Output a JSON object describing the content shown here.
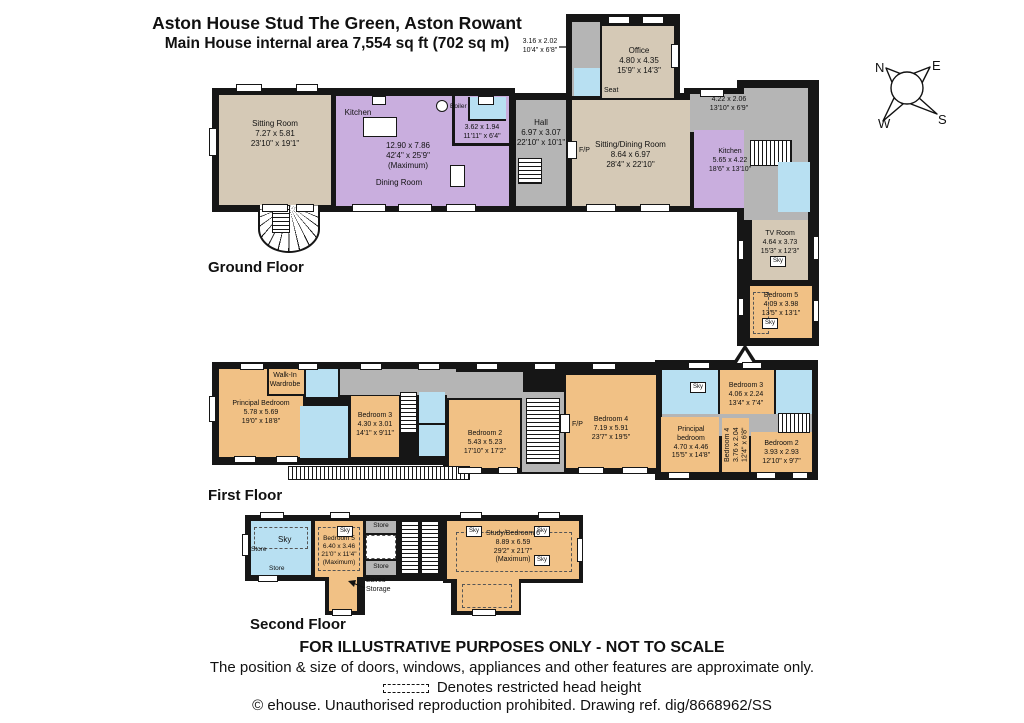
{
  "header": {
    "line1": "Aston House Stud The Green, Aston Rowant",
    "line2": "Main House internal area 7,554 sq ft (702 sq m)"
  },
  "compass": {
    "n": "N",
    "e": "E",
    "s": "S",
    "w": "W"
  },
  "labels": {
    "sky": "Sky",
    "fp": "F/P",
    "seat": "Seat",
    "boiler": "Boiler",
    "store": "Store"
  },
  "floors": {
    "ground": {
      "title": "Ground Floor",
      "annotation": [
        "3.16 x 2.02",
        "10'4\" x 6'8\""
      ],
      "rooms": {
        "sitting_room": [
          "Sitting Room",
          "7.27 x 5.81",
          "23'10\" x 19'1\""
        ],
        "kitchen_name": "Kitchen",
        "kitchen_dining_dims": [
          "12.90 x 7.86",
          "42'4\" x 25'9\"",
          "(Maximum)"
        ],
        "dining_room": "Dining Room",
        "utility": [
          "3.62 x 1.94",
          "11'11\" x 6'4\""
        ],
        "hall": [
          "Hall",
          "6.97 x 3.07",
          "22'10\" x 10'1\""
        ],
        "sitting_dining": [
          "Sitting/Dining Room",
          "8.64 x 6.97",
          "28'4\" x 22'10\""
        ],
        "office": [
          "Office",
          "4.80 x 4.35",
          "15'9\" x 14'3\""
        ],
        "porch": [
          "4.22 x 2.06",
          "13'10\" x 6'9\""
        ],
        "kitchen2": [
          "Kitchen",
          "5.65 x 4.22",
          "18'6\" x 13'10\""
        ],
        "tv_room": [
          "TV Room",
          "4.64 x 3.73",
          "15'3\" x 12'3\""
        ],
        "bedroom5": [
          "Bedroom 5",
          "4.09 x 3.98",
          "13'5\" x 13'1\""
        ]
      }
    },
    "first": {
      "title": "First Floor",
      "rooms": {
        "principal_bedroom": [
          "Principal Bedroom",
          "5.78 x 5.69",
          "19'0\" x 18'8\""
        ],
        "walk_in": [
          "Walk-In",
          "Wardrobe"
        ],
        "bedroom3": [
          "Bedroom 3",
          "4.30 x 3.01",
          "14'1\" x 9'11\""
        ],
        "bedroom2": [
          "Bedroom 2",
          "5.43 x 5.23",
          "17'10\" x 17'2\""
        ],
        "bedroom4": [
          "Bedroom 4",
          "7.19 x 5.91",
          "23'7\" x 19'5\""
        ],
        "bedroom3_right": [
          "Bedroom 3",
          "4.06 x 2.24",
          "13'4\" x 7'4\""
        ],
        "principal_right": [
          "Principal",
          "bedroom",
          "4.70 x 4.46",
          "15'5\" x 14'8\""
        ],
        "bedroom4_right": [
          "Bedroom 4",
          "3.76 x 2.04",
          "12'4\" x 6'8\""
        ],
        "bedroom2_right": [
          "Bedroom 2",
          "3.93 x 2.93",
          "12'10\" x 9'7\""
        ]
      }
    },
    "second": {
      "title": "Second Floor",
      "rooms": {
        "bedroom5": [
          "Bedroom 5",
          "6.40 x 3.46",
          "21'0\" x 11'4\"",
          "(Maximum)"
        ],
        "study_bedroom6": [
          "Study/Bedroom 6",
          "8.89 x 6.59",
          "29'2\" x 21'7\"",
          "(Maximum)"
        ],
        "eaves_storage": [
          "Eaves",
          "Storage"
        ]
      }
    }
  },
  "footer": {
    "line1": "FOR ILLUSTRATIVE PURPOSES ONLY - NOT TO SCALE",
    "line2": "The position & size of doors, windows, appliances and other features are approximate only.",
    "line3": "Denotes restricted head height",
    "line4": "© ehouse. Unauthorised reproduction prohibited. Drawing ref. dig/8668962/SS"
  },
  "colors": {
    "wall": "#161616",
    "reception_beige": "#d5c9b6",
    "kitchen_purple": "#c9aede",
    "circulation_gray": "#b5b5b5",
    "bathroom_blue": "#b8e0f2",
    "bedroom_orange": "#f1c185"
  }
}
